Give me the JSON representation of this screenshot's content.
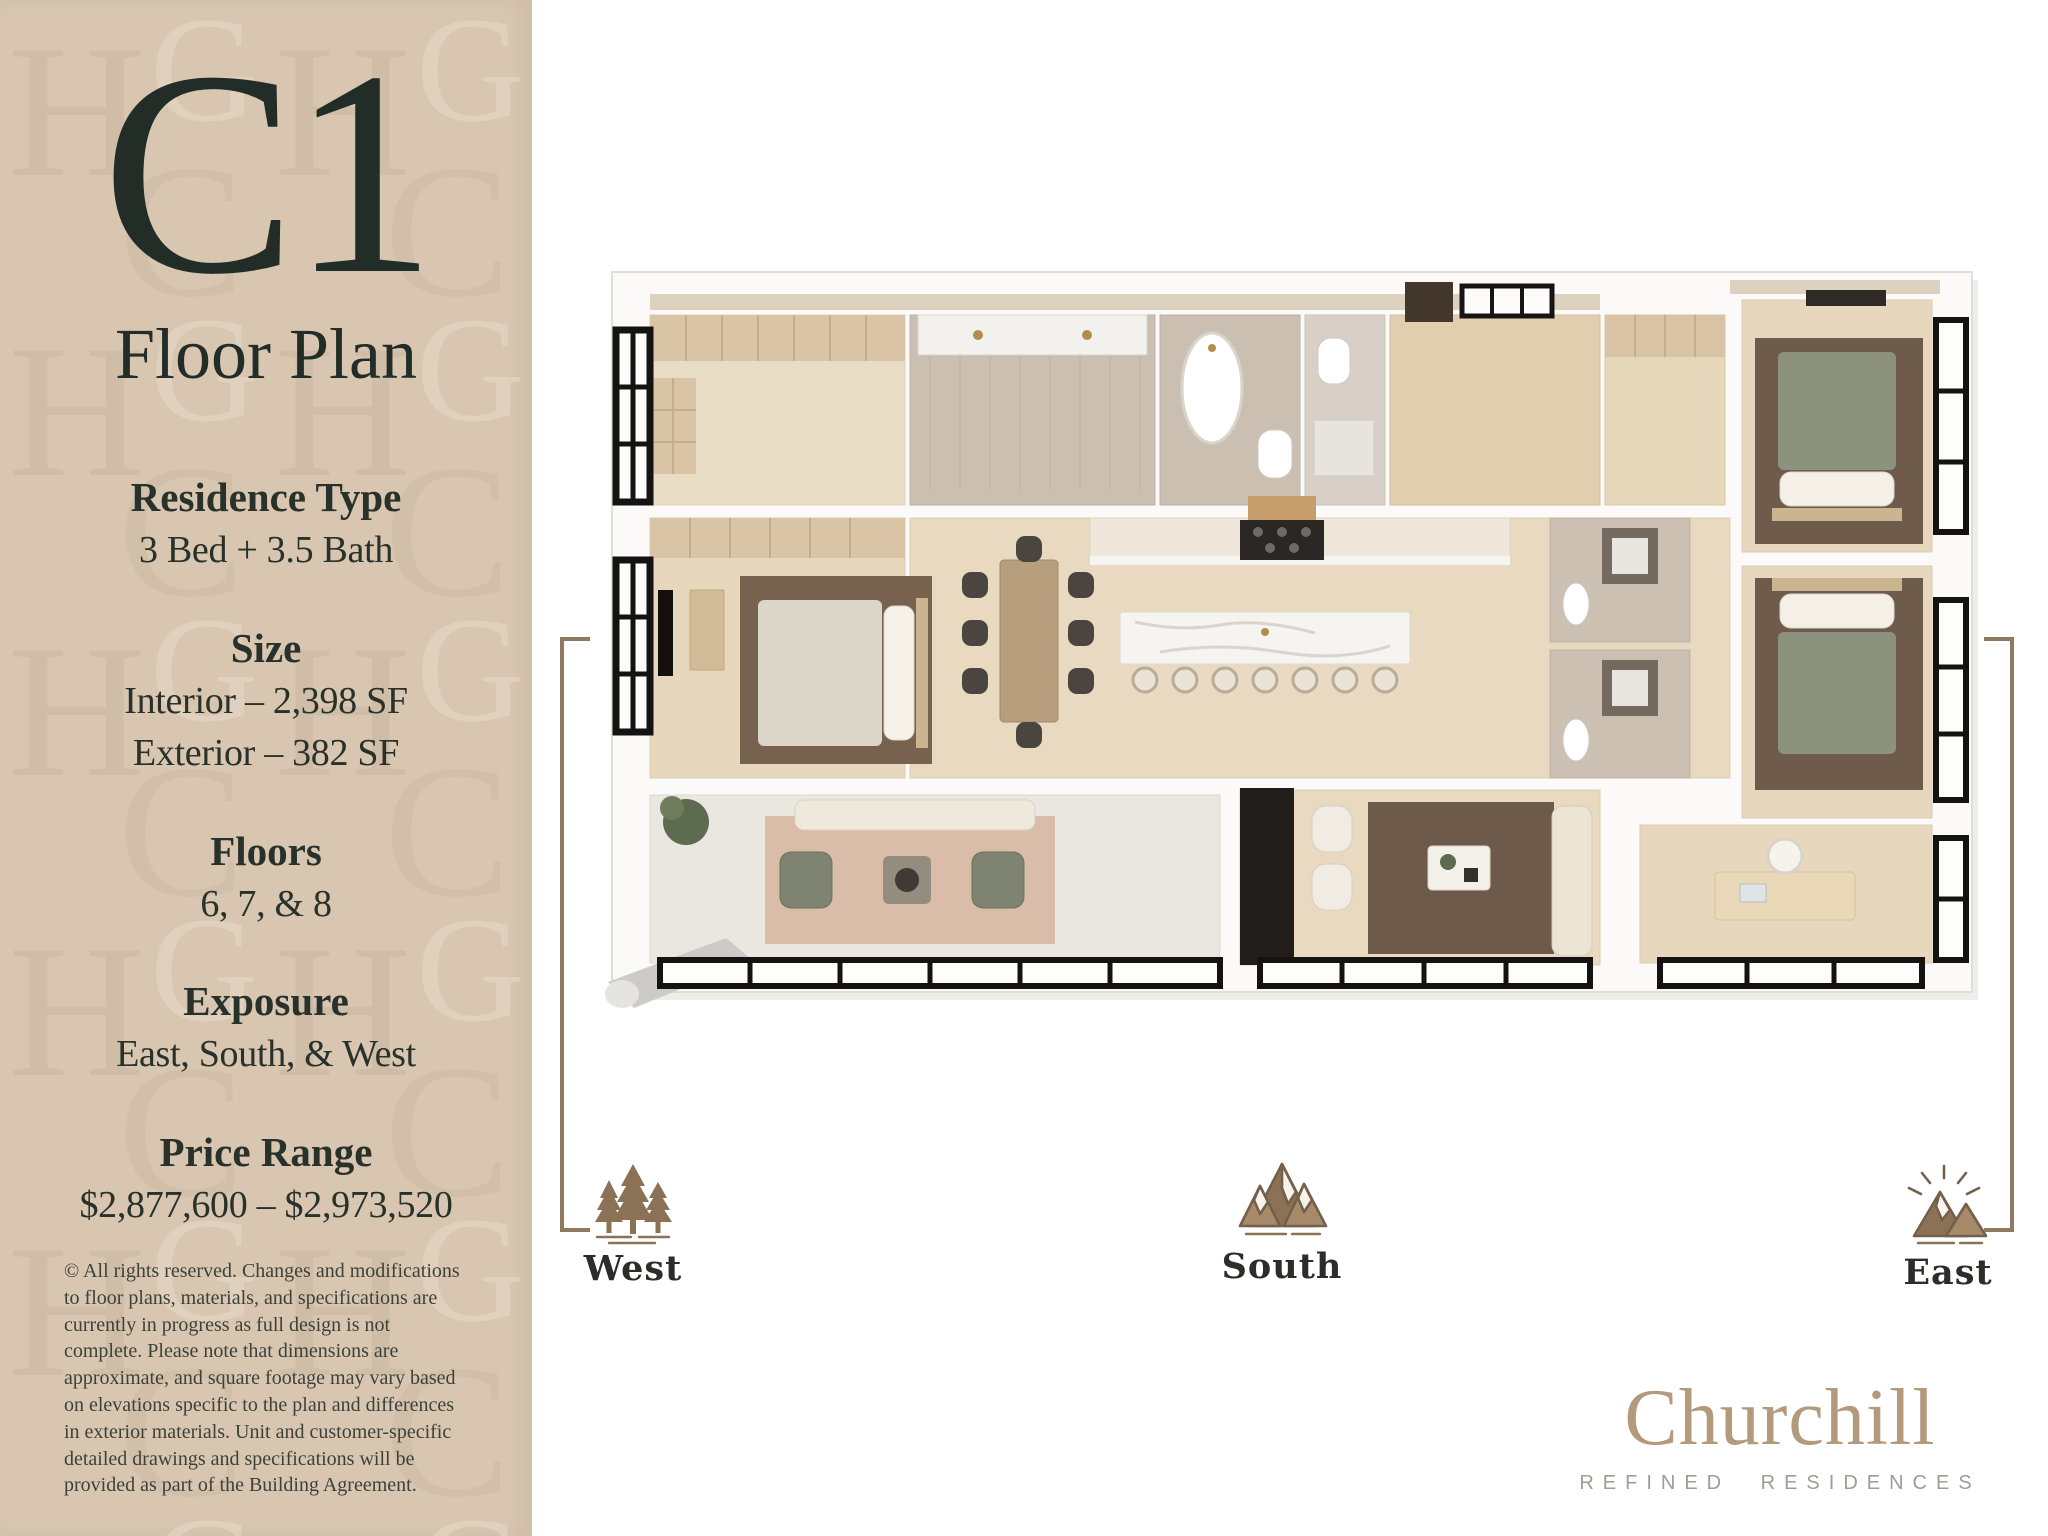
{
  "colors": {
    "sidebar_bg": "#d8c6b1",
    "ink": "#2b332c",
    "accent_brown": "#8f7a5f",
    "logo_bronze": "#b49a7c",
    "tagline_gray": "#9f9d99",
    "disclaimer": "#3c413a"
  },
  "sidebar": {
    "plan_code": "C1",
    "plan_label": "Floor Plan",
    "specs": [
      {
        "label": "Residence Type",
        "values": [
          "3 Bed + 3.5 Bath"
        ]
      },
      {
        "label": "Size",
        "values": [
          "Interior – 2,398 SF",
          "Exterior – 382 SF"
        ]
      },
      {
        "label": "Floors",
        "values": [
          "6, 7, & 8"
        ]
      },
      {
        "label": "Exposure",
        "values": [
          "East, South, & West"
        ]
      },
      {
        "label": "Price Range",
        "values": [
          "$2,877,600 – $2,973,520"
        ]
      }
    ],
    "disclaimer": "© All rights reserved. Changes and modifications to floor plans, materials, and specifications are currently in progress as full design is not complete. Please note that dimensions are approximate, and square footage may vary based on elevations specific to the plan and differences in exterior materials. Unit and customer-specific detailed drawings and specifications will be provided as part of the Building Agreement."
  },
  "compass": {
    "west": {
      "label": "West",
      "icon": "pine-trees-icon"
    },
    "south": {
      "label": "South",
      "icon": "mountains-icon"
    },
    "east": {
      "label": "East",
      "icon": "sunrise-mountain-icon"
    }
  },
  "floor_plan": {
    "description": "3D top-down rendering of residence C1: primary suite and terrace on the west, kitchen with island and dining at center, two bedrooms with baths and a den on the east"
  },
  "brand": {
    "name": "Churchill",
    "tagline": "REFINED RESIDENCES"
  }
}
